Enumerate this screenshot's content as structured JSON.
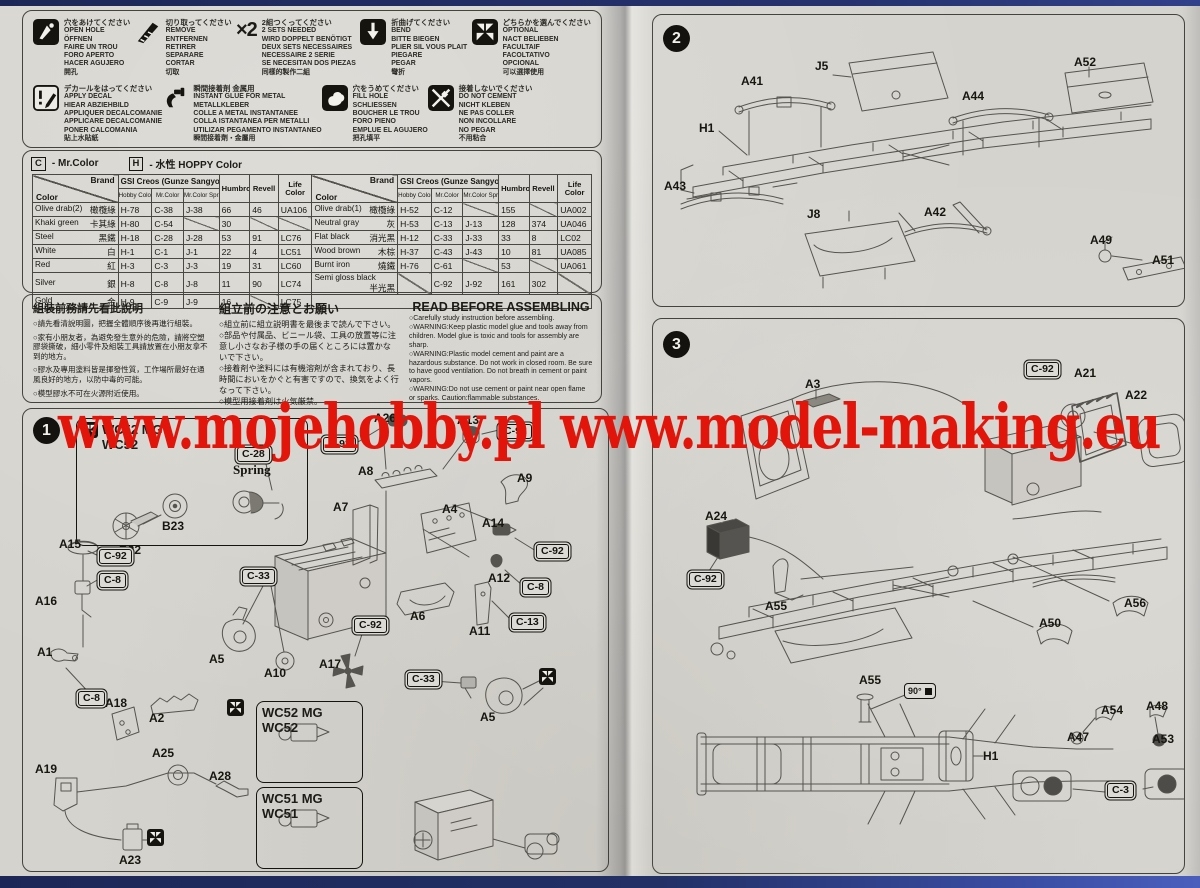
{
  "watermark": {
    "text": "www.mojehobby.pl www.model-making.eu",
    "color": "#e2150b"
  },
  "legend": {
    "rows": [
      [
        {
          "icon": "open-hole",
          "lines": [
            "穴をあけてください",
            "OPEN HOLE",
            "ÖFFNEN",
            "FAIRE UN TROU",
            "FORO APERTO",
            "HACER AGUJERO",
            "開孔"
          ]
        },
        {
          "icon": "remove",
          "lines": [
            "切り取ってください",
            "REMOVE",
            "ENTFERNEN",
            "RETIRER",
            "SEPARARE",
            "CORTAR",
            "切取"
          ]
        },
        {
          "icon": "x2",
          "glyph": "×2",
          "lines": [
            "2組つくってください",
            "2 SETS NEEDED",
            "WIRD DOPPELT BENÖTIGT",
            "DEUX SETS NECESSAIRES",
            "NECESSAIRE 2 SERIE",
            "SE NECESITAN DOS PIEZAS",
            "同樣的製作二組"
          ]
        },
        {
          "icon": "bend",
          "lines": [
            "折曲げてください",
            "BEND",
            "BITTE BIEGEN",
            "PLIER SIL VOUS PLAIT",
            "PIEGARE",
            "PEGAR",
            "彎折"
          ]
        },
        {
          "icon": "optional",
          "lines": [
            "どちらかを選んでください",
            "OPTIONAL",
            "NACT BELIEBEN",
            "FACULTAIF",
            "FACOLTATIVO",
            "OPCIONAL",
            "可以選擇使用"
          ]
        }
      ],
      [
        {
          "icon": "apply-decal",
          "lines": [
            "デカールをはってください",
            "APPLY DECAL",
            "HIEAR ABZIEHBILD",
            "APPLIQUER DECALCOMANIE",
            "APPLICARE DECALCOMANIE",
            "PONER CALCOMANIA",
            "貼上水貼紙"
          ]
        },
        {
          "icon": "instant-glue",
          "lines": [
            "瞬間接着剤 金属用",
            "INSTANT GLUE FOR METAL",
            "METALLKLEBER",
            "COLLE A METAL INSTANTANEE",
            "COLLA ISTANTANEA PER METALLI",
            "UTILIZAR PEGAMENTO INSTANTANEO",
            "瞬間接着劑・金屬用"
          ]
        },
        {
          "icon": "fill-hole",
          "lines": [
            "穴をうめてください",
            "FILL HOLE",
            "SCHLIESSEN",
            "BOUCHER LE TROU",
            "FORO PIENO",
            "EMPLUE EL AGUJERO",
            "把孔填平"
          ]
        },
        {
          "icon": "do-not-cement",
          "lines": [
            "接着しないでください",
            "DO NOT CEMENT",
            "NICHT KLEBEN",
            "NE PAS COLLER",
            "NON INCOLLARE",
            "NO PEGAR",
            "不用粘合"
          ]
        }
      ]
    ]
  },
  "color_chart": {
    "key_c": {
      "code": "C",
      "label": "- Mr.Color"
    },
    "key_h": {
      "code": "H",
      "label": "- 水性 HOPPY Color"
    },
    "header": {
      "brand": "Brand",
      "color": "Color",
      "gsi": "GSI Creos (Gunze Sangyo)",
      "sub": [
        "Hobby Color",
        "Mr.Color",
        "Mr.Color Spray"
      ],
      "humbrol": "Humbrol",
      "revell": "Revell",
      "life": "Life Color"
    },
    "left_rows": [
      {
        "name": "Olive drab(2)",
        "cjk": "橄欖綠",
        "cells": [
          "H-78",
          "C-38",
          "J-38",
          "66",
          "46",
          "UA106"
        ]
      },
      {
        "name": "Khaki green",
        "cjk": "卡其綠",
        "cells": [
          "H-80",
          "C-54",
          "",
          "30",
          "",
          ""
        ]
      },
      {
        "name": "Steel",
        "cjk": "黑鐵",
        "cells": [
          "H-18",
          "C-28",
          "J-28",
          "53",
          "91",
          "LC76"
        ]
      },
      {
        "name": "White",
        "cjk": "白",
        "cells": [
          "H-1",
          "C-1",
          "J-1",
          "22",
          "4",
          "LC51"
        ]
      },
      {
        "name": "Red",
        "cjk": "紅",
        "cells": [
          "H-3",
          "C-3",
          "J-3",
          "19",
          "31",
          "LC60"
        ]
      },
      {
        "name": "Silver",
        "cjk": "銀",
        "cells": [
          "H-8",
          "C-8",
          "J-8",
          "11",
          "90",
          "LC74"
        ]
      },
      {
        "name": "Gold",
        "cjk": "金",
        "cells": [
          "H-9",
          "C-9",
          "J-9",
          "16",
          "",
          "LC75"
        ]
      }
    ],
    "right_rows": [
      {
        "name": "Olive drab(1)",
        "cjk": "橄欖綠",
        "cells": [
          "H-52",
          "C-12",
          "",
          "155",
          "",
          "UA002"
        ]
      },
      {
        "name": "Neutral gray",
        "cjk": "灰",
        "cells": [
          "H-53",
          "C-13",
          "J-13",
          "128",
          "374",
          "UA046"
        ]
      },
      {
        "name": "Flat black",
        "cjk": "消光黑",
        "cells": [
          "H-12",
          "C-33",
          "J-33",
          "33",
          "8",
          "LC02"
        ]
      },
      {
        "name": "Wood brown",
        "cjk": "木棕",
        "cells": [
          "H-37",
          "C-43",
          "J-43",
          "10",
          "81",
          "UA085"
        ]
      },
      {
        "name": "Burnt iron",
        "cjk": "燒鐵",
        "cells": [
          "H-76",
          "C-61",
          "",
          "53",
          "",
          "UA061"
        ]
      },
      {
        "name": "Semi gloss black",
        "cjk": "半光黑",
        "cells": [
          "",
          "C-92",
          "J-92",
          "161",
          "302",
          ""
        ]
      }
    ]
  },
  "read_before": {
    "columns": [
      {
        "lang": "zh",
        "title": "組裝前務請先看此說明",
        "items": [
          "○請先看清說明圖，把握全體順序後再進行組裝。",
          "○家有小朋友者，為避免發生意外的危險，請將空塑膠袋撕破，細小零件及組裝工具請放置在小朋友拿不到的地方。",
          "○膠水及專用塗料皆是揮發性質，工作場所最好在通風良好的地方，以防中毒的可能。",
          "○模型膠水不可在火源附近使用。"
        ]
      },
      {
        "lang": "ja",
        "title": "組立前の注意とお願い",
        "items": [
          "○組立前に組立説明書を最後まで読んで下さい。",
          "○部品や付属品、ビニール袋、工具の放置等に注意し小さなお子様の手の届くところには置かないで下さい。",
          "○接着剤や塗料には有機溶剤が含まれており、長時間においをかぐと有害ですので、換気をよく行なって下さい。",
          "○模型用接着剤は火気厳禁。"
        ]
      },
      {
        "lang": "en",
        "title": "READ BEFORE ASSEMBLING",
        "items": [
          "○Carefully study instruction before assembling.",
          "○WARNING:Keep plastic model glue and tools away from children. Model glue is toxic and tools for assembly are sharp.",
          "○WARNING:Plastic model cement and paint are a hazardous substance. Do not work in closed room. Be sure to have good ventilation. Do not breath in cement or paint vapors.",
          "○WARNING:Do not use cement or paint near open flame or sparks. Caution:flammable substances."
        ]
      }
    ]
  },
  "steps": [
    {
      "number": "1",
      "labels": [
        {
          "type": "groupbox",
          "x": 53,
          "y": 9,
          "w": 220,
          "h": 120,
          "icon": "optional",
          "lines": [
            "WC52 MG",
            "WC52"
          ]
        },
        {
          "type": "callout",
          "text": "C-28",
          "x": 214,
          "y": 38
        },
        {
          "type": "text",
          "text": "Spring",
          "x": 210,
          "y": 53
        },
        {
          "type": "part",
          "text": "B22",
          "x": 96,
          "y": 134
        },
        {
          "type": "part",
          "text": "B23",
          "x": 139,
          "y": 110
        },
        {
          "type": "part",
          "text": "A15",
          "x": 36,
          "y": 128
        },
        {
          "type": "callout",
          "text": "C-92",
          "x": 76,
          "y": 140
        },
        {
          "type": "callout",
          "text": "C-8",
          "x": 76,
          "y": 164
        },
        {
          "type": "part",
          "text": "A16",
          "x": 12,
          "y": 185
        },
        {
          "type": "part",
          "text": "A1",
          "x": 14,
          "y": 236
        },
        {
          "type": "callout",
          "text": "C-8",
          "x": 55,
          "y": 282
        },
        {
          "type": "part",
          "text": "A2",
          "x": 126,
          "y": 302
        },
        {
          "type": "part",
          "text": "A18",
          "x": 82,
          "y": 287
        },
        {
          "type": "part",
          "text": "A19",
          "x": 12,
          "y": 353
        },
        {
          "type": "part",
          "text": "A25",
          "x": 129,
          "y": 337
        },
        {
          "type": "part",
          "text": "A28",
          "x": 186,
          "y": 360
        },
        {
          "type": "part",
          "text": "A23",
          "x": 96,
          "y": 444
        },
        {
          "type": "icon",
          "icon": "optional",
          "x": 124,
          "y": 420
        },
        {
          "type": "part",
          "text": "A26",
          "x": 351,
          "y": 2
        },
        {
          "type": "part",
          "text": "A13",
          "x": 434,
          "y": 4
        },
        {
          "type": "callout",
          "text": "C-92",
          "x": 476,
          "y": 15
        },
        {
          "type": "callout",
          "text": "C-92",
          "x": 300,
          "y": 28
        },
        {
          "type": "part",
          "text": "A8",
          "x": 335,
          "y": 55
        },
        {
          "type": "part",
          "text": "A9",
          "x": 494,
          "y": 62
        },
        {
          "type": "part",
          "text": "A7",
          "x": 310,
          "y": 91
        },
        {
          "type": "part",
          "text": "A4",
          "x": 419,
          "y": 93
        },
        {
          "type": "part",
          "text": "A14",
          "x": 459,
          "y": 107
        },
        {
          "type": "part",
          "text": "A12",
          "x": 465,
          "y": 162
        },
        {
          "type": "callout",
          "text": "C-92",
          "x": 513,
          "y": 135
        },
        {
          "type": "part",
          "text": "A6",
          "x": 387,
          "y": 200
        },
        {
          "type": "part",
          "text": "A11",
          "x": 446,
          "y": 215
        },
        {
          "type": "callout",
          "text": "C-8",
          "x": 499,
          "y": 171
        },
        {
          "type": "callout",
          "text": "C-13",
          "x": 488,
          "y": 206
        },
        {
          "type": "callout",
          "text": "C-92",
          "x": 331,
          "y": 209
        },
        {
          "type": "part",
          "text": "A17",
          "x": 296,
          "y": 248
        },
        {
          "type": "callout",
          "text": "C-33",
          "x": 219,
          "y": 160
        },
        {
          "type": "part",
          "text": "A5",
          "x": 186,
          "y": 243
        },
        {
          "type": "part",
          "text": "A10",
          "x": 241,
          "y": 257
        },
        {
          "type": "icon",
          "icon": "optional",
          "x": 204,
          "y": 290
        },
        {
          "type": "callout",
          "text": "C-33",
          "x": 384,
          "y": 263
        },
        {
          "type": "part",
          "text": "A5",
          "x": 457,
          "y": 301
        },
        {
          "type": "icon",
          "icon": "optional",
          "x": 516,
          "y": 259
        },
        {
          "type": "groupbox",
          "x": 233,
          "y": 292,
          "w": 95,
          "h": 74,
          "lines": [
            "WC52 MG",
            "WC52"
          ]
        },
        {
          "type": "groupbox",
          "x": 233,
          "y": 378,
          "w": 95,
          "h": 74,
          "lines": [
            "WC51 MG",
            "WC51"
          ]
        }
      ]
    },
    {
      "number": "2",
      "labels": [
        {
          "type": "part",
          "text": "A41",
          "x": 88,
          "y": 59
        },
        {
          "type": "part",
          "text": "J5",
          "x": 162,
          "y": 44
        },
        {
          "type": "part",
          "text": "H1",
          "x": 46,
          "y": 106
        },
        {
          "type": "part",
          "text": "A43",
          "x": 11,
          "y": 164
        },
        {
          "type": "part",
          "text": "J8",
          "x": 154,
          "y": 192
        },
        {
          "type": "part",
          "text": "A42",
          "x": 271,
          "y": 190
        },
        {
          "type": "part",
          "text": "A44",
          "x": 309,
          "y": 74
        },
        {
          "type": "part",
          "text": "A52",
          "x": 421,
          "y": 40
        },
        {
          "type": "part",
          "text": "A49",
          "x": 437,
          "y": 218
        },
        {
          "type": "part",
          "text": "A51",
          "x": 499,
          "y": 238
        }
      ]
    },
    {
      "number": "3",
      "labels": [
        {
          "type": "part",
          "text": "A3",
          "x": 152,
          "y": 58
        },
        {
          "type": "callout",
          "text": "C-92",
          "x": 373,
          "y": 43
        },
        {
          "type": "part",
          "text": "A21",
          "x": 421,
          "y": 47
        },
        {
          "type": "part",
          "text": "A22",
          "x": 472,
          "y": 69
        },
        {
          "type": "part",
          "text": "A24",
          "x": 52,
          "y": 190
        },
        {
          "type": "callout",
          "text": "C-92",
          "x": 36,
          "y": 253
        },
        {
          "type": "part",
          "text": "A55",
          "x": 112,
          "y": 280
        },
        {
          "type": "part",
          "text": "A50",
          "x": 386,
          "y": 297
        },
        {
          "type": "part",
          "text": "A56",
          "x": 471,
          "y": 277
        },
        {
          "type": "part",
          "text": "A55",
          "x": 206,
          "y": 354
        },
        {
          "type": "angle",
          "text": "90°",
          "x": 251,
          "y": 364
        },
        {
          "type": "part",
          "text": "H1",
          "x": 330,
          "y": 430
        },
        {
          "type": "part",
          "text": "A54",
          "x": 448,
          "y": 384
        },
        {
          "type": "part",
          "text": "A47",
          "x": 414,
          "y": 411
        },
        {
          "type": "part",
          "text": "A48",
          "x": 493,
          "y": 380
        },
        {
          "type": "part",
          "text": "A53",
          "x": 499,
          "y": 413
        },
        {
          "type": "callout",
          "text": "C-3",
          "x": 454,
          "y": 464
        }
      ]
    }
  ]
}
